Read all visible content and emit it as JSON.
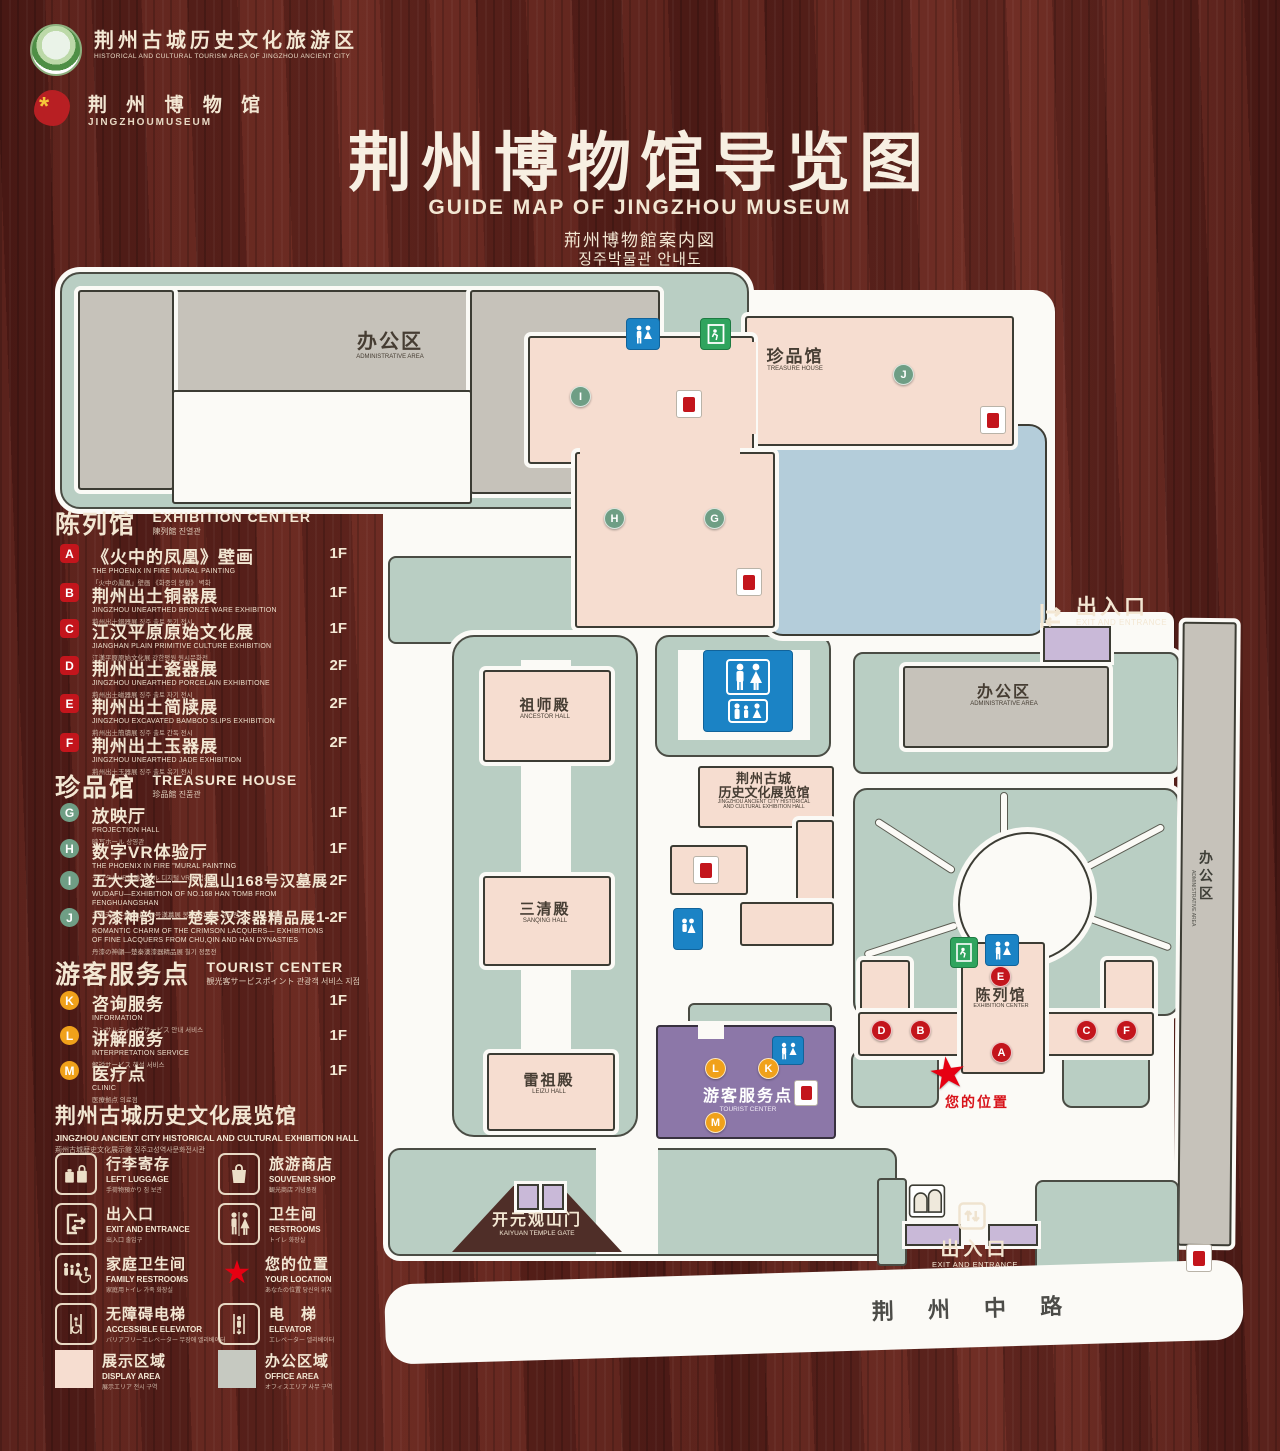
{
  "header": {
    "logo1": {
      "title": "荆州古城历史文化旅游区",
      "subtitle": "HISTORICAL AND CULTURAL TOURISM AREA OF JINGZHOU ANCIENT CITY"
    },
    "logo2": {
      "title": "荆 州 博 物 馆",
      "subtitle": "JINGZHOUMUSEUM"
    },
    "title": "荆州博物馆导览图",
    "subtitle_en": "GUIDE MAP OF JINGZHOU MUSEUM",
    "subtitle_ja": "荊州博物館案内図",
    "subtitle_ko": "징주박물관 안내도"
  },
  "legend": {
    "sections": [
      {
        "title_zh": "陈列馆",
        "title_en": "EXHIBITION CENTER",
        "title_sub": "陳列館  진열관",
        "items": [
          {
            "letter": "A",
            "zh": "《火中的凤凰》壁画",
            "en": "THE PHOENIX IN FIRE 'MURAL PAINTING",
            "sub": "「火中の鳳凰」壁画  《화중의 봉황》 벽화",
            "floor": "1F"
          },
          {
            "letter": "B",
            "zh": "荆州出土铜器展",
            "en": "JINGZHOU UNEARTHED BRONZE WARE EXHIBITION",
            "sub": "荊州出土銅器展  징주 출토 동기 전시",
            "floor": "1F"
          },
          {
            "letter": "C",
            "zh": "江汉平原原始文化展",
            "en": "JIANGHAN PLAIN PRIMITIVE CULTURE EXHIBITION",
            "sub": "江漢平原原始文化展  강한평원 원시문화전",
            "floor": "1F"
          },
          {
            "letter": "D",
            "zh": "荆州出土瓷器展",
            "en": "JINGZHOU UNEARTHED PORCELAIN EXHIBITIONE",
            "sub": "荊州出土磁器展  징주 출토 자기 전시",
            "floor": "2F"
          },
          {
            "letter": "E",
            "zh": "荆州出土简牍展",
            "en": "JINGZHOU EXCAVATED BAMBOO SLIPS EXHIBITION",
            "sub": "荊州出土簡牘展  징주 출토 간독 전시",
            "floor": "2F"
          },
          {
            "letter": "F",
            "zh": "荆州出土玉器展",
            "en": "JINGZHOU UNEARTHED JADE EXHIBITION",
            "sub": "荊州出土玉器展  징주 출토 옥기 전시",
            "floor": "2F"
          }
        ]
      },
      {
        "title_zh": "珍品馆",
        "title_en": "TREASURE HOUSE",
        "title_sub": "珍品館  진품관",
        "items": [
          {
            "letter": "G",
            "zh": "放映厅",
            "en": "PROJECTION HALL",
            "sub": "映写ホール  상영관",
            "floor": "1F"
          },
          {
            "letter": "H",
            "zh": "数字VR体验厅",
            "en": "THE PHOENIX IN FIRE \"MURAL PAINTING",
            "sub": "デジタルVR体験ホール  디지털 VR 체험관",
            "floor": "1F"
          },
          {
            "letter": "I",
            "zh": "五大夫遂——凤凰山168号汉墓展",
            "en": "WUDAFU—EXHIBITION OF NO.168 HAN TOMB FROM FENGHUANGSHAN",
            "sub": "五大夫遂—鳳凰山168号漢墓展  봉황산 168호 한묘전",
            "floor": "2F"
          },
          {
            "letter": "J",
            "zh": "丹漆神韵——楚秦汉漆器精品展",
            "en": "ROMANTIC CHARM OF THE CRIMSON LACQUERS— EXHIBITIONS OF FINE LACQUERS FROM CHU,QIN AND HAN DYNASTIES",
            "sub": "丹漆の神韻—楚秦漢漆器精品展  칠기 정품전",
            "floor": "1-2F"
          }
        ]
      },
      {
        "title_zh": "游客服务点",
        "title_en": "TOURIST CENTER",
        "title_sub": "観光客サービスポイント  관광객 서비스 지점",
        "items": [
          {
            "letter": "K",
            "zh": "咨询服务",
            "en": "INFORMATION",
            "sub": "コンサルティングサービス  안내 서비스",
            "floor": "1F"
          },
          {
            "letter": "L",
            "zh": "讲解服务",
            "en": "INTERPRETATION SERVICE",
            "sub": "解説サービス  해설 서비스",
            "floor": "1F"
          },
          {
            "letter": "M",
            "zh": "医疗点",
            "en": "CLINIC",
            "sub": "医療拠点  의료점",
            "floor": "1F"
          }
        ]
      }
    ],
    "hall_note": {
      "zh": "荆州古城历史文化展览馆",
      "en": "JINGZHOU ANCIENT CITY HISTORICAL AND CULTURAL EXHIBITION HALL",
      "sub": "荊州古城歴史文化展示館    징주고성역사문화전시관"
    },
    "icons": [
      {
        "zh": "行李寄存",
        "en": "LEFT LUGGAGE",
        "sub": "手荷物預かり  짐 보관",
        "icon": "luggage-icon"
      },
      {
        "zh": "旅游商店",
        "en": "SOUVENIR SHOP",
        "sub": "観光商店  기념품점",
        "icon": "shopping-bag-icon"
      },
      {
        "zh": "出入口",
        "en": "EXIT AND ENTRANCE",
        "sub": "出入口  출입구",
        "icon": "exit-entrance-icon"
      },
      {
        "zh": "卫生间",
        "en": "RESTROOMS",
        "sub": "トイレ  화장실",
        "icon": "restroom-icon"
      },
      {
        "zh": "家庭卫生间",
        "en": "FAMILY RESTROOMS",
        "sub": "家庭用トイレ  가족 화장실",
        "icon": "family-restroom-icon"
      },
      {
        "zh": "您的位置",
        "en": "YOUR LOCATION",
        "sub": "あなたの位置  당신의 위치",
        "icon": "location-star-icon"
      },
      {
        "zh": "无障碍电梯",
        "en": "ACCESSIBLE ELEVATOR",
        "sub": "バリアフリーエレベーター  무장애 엘리베이터",
        "icon": "accessible-elevator-icon"
      },
      {
        "zh": "电　梯",
        "en": "ELEVATOR",
        "sub": "エレベーター  엘리베이터",
        "icon": "elevator-icon"
      },
      {
        "zh": "展示区域",
        "en": "DISPLAY AREA",
        "sub": "展示エリア  전시 구역",
        "icon": "display-area-swatch"
      },
      {
        "zh": "办公区域",
        "en": "OFFICE AREA",
        "sub": "オフィスエリア  사무 구역",
        "icon": "office-area-swatch"
      }
    ]
  },
  "map": {
    "admin_area_zh": "办公区",
    "admin_area_en": "ADMINISTRATIVE AREA",
    "treasure_zh": "珍品馆",
    "treasure_en": "TREASURE HOUSE",
    "ancestor_zh": "祖师殿",
    "ancestor_en": "ANCESTOR HALL",
    "sanqing_zh": "三清殿",
    "sanqing_en": "SANQING HALL",
    "leizu_zh": "雷祖殿",
    "leizu_en": "LEIZU HALL",
    "exhibhall_zh1": "荆州古城",
    "exhibhall_zh2": "历史文化展览馆",
    "exhibhall_en1": "JINGZHOU ANCIENT CITY HISTORICAL",
    "exhibhall_en2": "AND CULTURAL EXHIBITION HALL",
    "exhibcenter_zh": "陈列馆",
    "exhibcenter_en": "EXHIBITION CENTER",
    "tourist_zh": "游客服务点",
    "tourist_en": "TOURIST CENTER",
    "gate_zh": "开元观山门",
    "gate_en": "KAIYUAN TEMPLE GATE",
    "exit_zh": "出入口",
    "exit_en": "EXIT AND ENTRANCE",
    "your_location": "您的位置",
    "road": "荆 州 中 路",
    "markers": [
      {
        "letter": "I"
      },
      {
        "letter": "J"
      },
      {
        "letter": "H"
      },
      {
        "letter": "G"
      },
      {
        "letter": "E"
      },
      {
        "letter": "D"
      },
      {
        "letter": "B"
      },
      {
        "letter": "C"
      },
      {
        "letter": "F"
      },
      {
        "letter": "A"
      },
      {
        "letter": "L"
      },
      {
        "letter": "K"
      },
      {
        "letter": "M"
      }
    ]
  },
  "colors": {
    "wood_background": "#5a201b",
    "walkway_sage": "#b9cec3",
    "display_area_pink": "#f6ddd0",
    "office_area_gray": "#c6c2ba",
    "water_blue": "#b4cdda",
    "tourist_center_purple": "#8c77a8",
    "entrance_lavender": "#c9b9d8",
    "marker_red": "#c3151c",
    "marker_green": "#6f9e85",
    "marker_orange": "#f0a11a",
    "restroom_blue": "#1b83c5",
    "exit_green": "#2fa45e",
    "location_star_red": "#e60012",
    "legend_text_cream": "#f3e7d3"
  }
}
